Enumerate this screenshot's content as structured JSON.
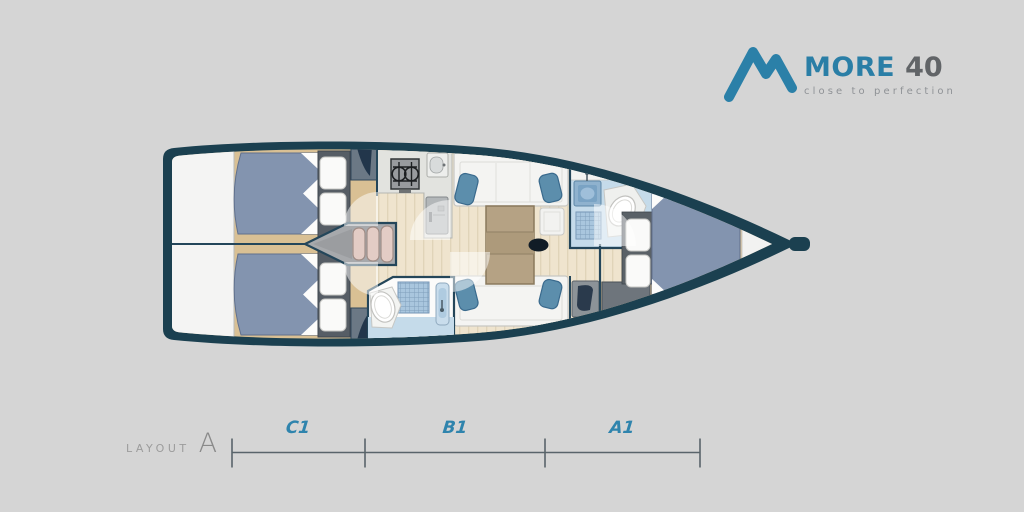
{
  "background_color": "#D5D5D5",
  "brand": {
    "name": "MORE",
    "model": "40",
    "tagline": "close to perfection",
    "logo_icon": "mountain-m-icon",
    "colors": {
      "brand_blue": "#2B80A8",
      "model_gray": "#616467",
      "tagline_gray": "#8F9296"
    }
  },
  "layout": {
    "label": "LAYOUT",
    "variant": "A",
    "sections": [
      {
        "label": "C1"
      },
      {
        "label": "B1"
      },
      {
        "label": "A1"
      }
    ],
    "section_label_color": "#2F84AD",
    "line_color": "#59646B"
  },
  "diagram": {
    "type": "yacht-floor-plan",
    "orientation": "bow-right",
    "colors": {
      "hull": "#1B4050",
      "wood": "#D9C094",
      "plank_floor": "#EFE4CE",
      "bed": "#8394AF",
      "cushion": "#5C8EAC",
      "bathroom_floor": "#C5DBEA",
      "steps": "#E3CCC5"
    },
    "rooms": [
      "transom-platform",
      "aft-cabin-port",
      "aft-cabin-starboard",
      "companionway-steps",
      "galley",
      "salon",
      "aft-head",
      "forward-head",
      "nav-seat",
      "forward-cabin",
      "bow-locker"
    ]
  }
}
